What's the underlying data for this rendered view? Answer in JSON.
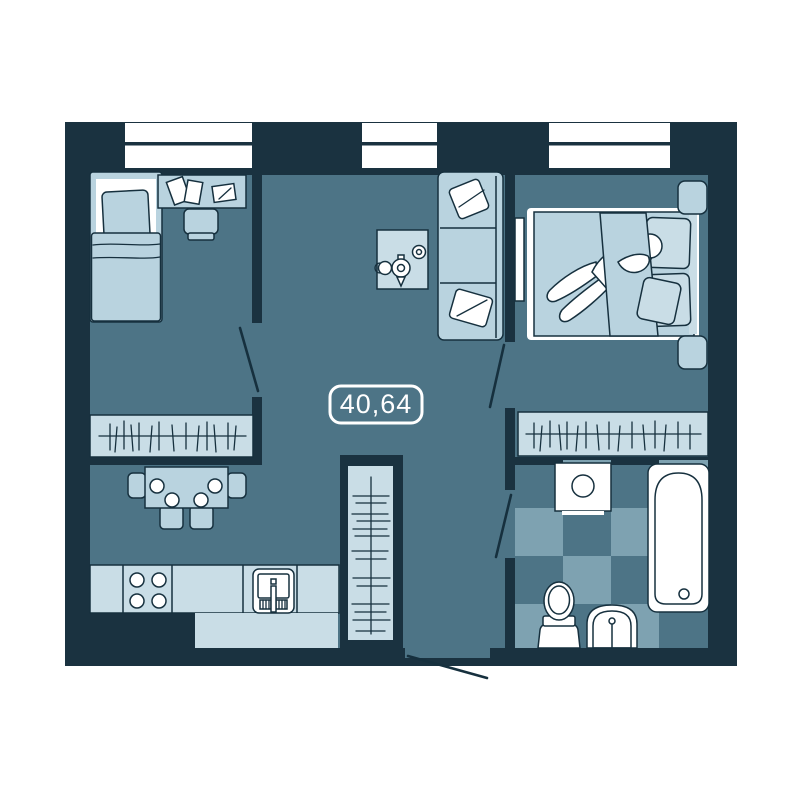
{
  "floor_plan": {
    "area_label": "40,64",
    "colors": {
      "page_bg": "#ffffff",
      "wall": "#1a3240",
      "floor": "#4d7486",
      "furniture": "#b9d3df",
      "furniture_light": "#c9dde6",
      "tile": "#7ea2b1",
      "fixture_white": "#ffffff",
      "outline": "#16303e"
    },
    "furniture_icons": [
      "window-icon",
      "door-swing-icon",
      "single-bed-icon",
      "pillow-icon",
      "desk-icon",
      "book-icon",
      "desk-chair-icon",
      "wardrobe-hangers-icon",
      "dining-table-icon",
      "dining-chair-icon",
      "plate-icon",
      "kitchen-counter-icon",
      "stove-burners-icon",
      "kitchen-sink-icon",
      "sofa-icon",
      "throw-pillow-icon",
      "coffee-table-icon",
      "teapot-icon",
      "cup-icon",
      "tv-icon",
      "double-bed-icon",
      "sleeping-person-icon",
      "nightstand-icon",
      "washing-machine-icon",
      "bathtub-icon",
      "toilet-icon",
      "washbasin-icon",
      "tile-floor-icon",
      "entrance-door-icon"
    ]
  }
}
